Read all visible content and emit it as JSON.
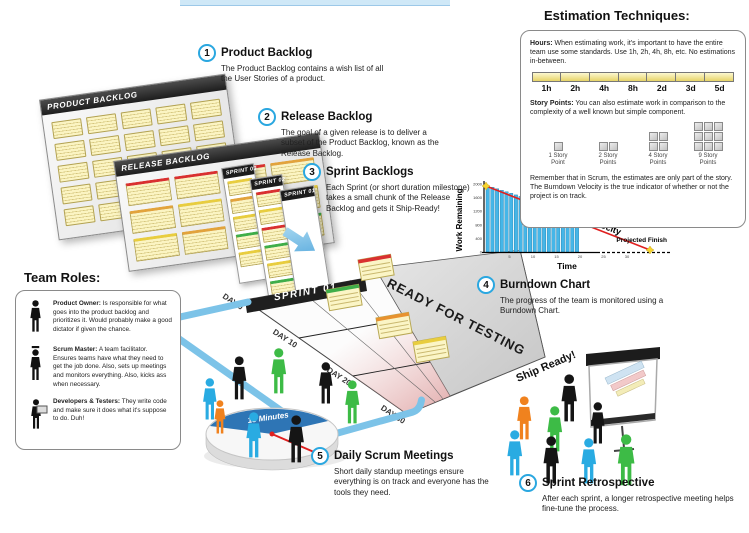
{
  "steps": [
    {
      "num": "1",
      "title": "Product Backlog",
      "body": "The Product Backlog contains a wish list of all the User Stories of a product."
    },
    {
      "num": "2",
      "title": "Release Backlog",
      "body": "The goal of a given release is to deliver a subset of the Product Backlog, known as the Release Backlog."
    },
    {
      "num": "3",
      "title": "Sprint Backlogs",
      "body": "Each Sprint (or short duration milestone) takes a small chunk of the Release Backlog and gets it Ship-Ready!"
    },
    {
      "num": "4",
      "title": "Burndown Chart",
      "body": "The progress of the team is monitored using a Burndown Chart."
    },
    {
      "num": "5",
      "title": "Daily Scrum Meetings",
      "body": "Short daily standup meetings ensure everything is on track and everyone has the tools they need."
    },
    {
      "num": "6",
      "title": "Sprint Retrospective",
      "body": "After each sprint, a longer retrospective meeting helps fine-tune the process."
    }
  ],
  "estimation": {
    "title": "Estimation Techniques:",
    "hours_label": "Hours:",
    "hours_text": "When estimating work, it's important to have the entire team use some standards. Use 1h, 2h, 4h, 8h, etc. No estimations in-between.",
    "ruler_labels": [
      "1h",
      "2h",
      "4h",
      "8h",
      "2d",
      "3d",
      "5d"
    ],
    "story_label": "Story Points:",
    "story_text": "You can also estimate work in comparison to the complexity of a well known but simple component.",
    "story_points": [
      {
        "count": 1,
        "cols": 1,
        "label": "1 Story Point"
      },
      {
        "count": 2,
        "cols": 2,
        "label": "2 Story Points"
      },
      {
        "count": 4,
        "cols": 2,
        "label": "4 Story Points"
      },
      {
        "count": 9,
        "cols": 3,
        "label": "9 Story Points"
      }
    ],
    "footer": "Remember that in Scrum, the estimates are only part of the story. The Burndown Velocity is the true indicator of whether or not the project is on track."
  },
  "team_roles": {
    "title": "Team Roles:",
    "roles": [
      {
        "name": "Product Owner:",
        "icon": "product-owner-icon",
        "text": "Is responsible for what goes into the product backlog and prioritizes it. Would probably make a good dictator if given the chance."
      },
      {
        "name": "Scrum Master:",
        "icon": "scrum-master-icon",
        "text": "A team facilitator. Ensures teams have what they need to get the job done. Also, sets up meetings and monitors everything. Also, kicks ass when necessary."
      },
      {
        "name": "Developers & Testers:",
        "icon": "developer-icon",
        "text": "They write code and make sure it does what it's suppose to do. Duh!"
      }
    ]
  },
  "boards": {
    "product": {
      "label": "PRODUCT BACKLOG",
      "rows": 5,
      "cols": 5
    },
    "release": {
      "label": "RELEASE BACKLOG",
      "stripe_rows": [
        [
          "#d93030",
          "#d93030",
          "#d93030",
          "#e2a33c"
        ],
        [
          "#e2a33c",
          "#e8cd3f",
          "#3fae49",
          "#e8cd3f"
        ],
        [
          "#e8cd3f",
          "#e2a33c",
          "#e8cd3f",
          "#3fae49"
        ]
      ]
    },
    "sprints": [
      {
        "label": "SPRINT 03",
        "stripes": [
          "#e8cd3f",
          "#e2a33c",
          "#e8cd3f",
          "#3fae49",
          "#e8cd3f"
        ]
      },
      {
        "label": "SPRINT 02",
        "stripes": [
          "#d93030",
          "#e8cd3f",
          "#d93030",
          "#3fae49",
          "#e8cd3f",
          "#3fae49"
        ]
      },
      {
        "label": "SPRINT 01",
        "stripes": []
      }
    ],
    "sprint_board_label": "SPRINT 01",
    "ready_label": "READY FOR TESTING",
    "ship_label": "Ship Ready!",
    "day_labels": [
      "DAY 0",
      "DAY 10",
      "DAY 20",
      "DAY 30"
    ],
    "board_notes": [
      {
        "x": 228,
        "y": 10,
        "color": "#d93030"
      },
      {
        "x": 196,
        "y": 40,
        "color": "#3fae49"
      },
      {
        "x": 246,
        "y": 68,
        "color": "#e8922f"
      },
      {
        "x": 283,
        "y": 92,
        "color": "#e8cd3f"
      }
    ]
  },
  "scrum_meeting": {
    "pie_label": "15 Minutes",
    "people": [
      {
        "x": 70,
        "y": 128,
        "h": 42,
        "color": "#29abe2"
      },
      {
        "x": 99,
        "y": 106,
        "h": 44,
        "color": "#151515"
      },
      {
        "x": 138,
        "y": 98,
        "h": 46,
        "color": "#3dbb46"
      },
      {
        "x": 186,
        "y": 112,
        "h": 42,
        "color": "#151515"
      },
      {
        "x": 212,
        "y": 130,
        "h": 44,
        "color": "#3dbb46"
      },
      {
        "x": 82,
        "y": 150,
        "h": 34,
        "color": "#f0821e"
      },
      {
        "x": 113,
        "y": 162,
        "h": 46,
        "color": "#29abe2"
      },
      {
        "x": 155,
        "y": 165,
        "h": 48,
        "color": "#151515"
      }
    ]
  },
  "retrospective": {
    "people": [
      {
        "x": 428,
        "y": 124,
        "h": 48,
        "color": "#151515"
      },
      {
        "x": 384,
        "y": 146,
        "h": 44,
        "color": "#f0821e"
      },
      {
        "x": 414,
        "y": 156,
        "h": 46,
        "color": "#3dbb46"
      },
      {
        "x": 458,
        "y": 152,
        "h": 42,
        "color": "#151515"
      },
      {
        "x": 374,
        "y": 180,
        "h": 46,
        "color": "#29abe2"
      },
      {
        "x": 410,
        "y": 186,
        "h": 48,
        "color": "#151515"
      },
      {
        "x": 448,
        "y": 188,
        "h": 46,
        "color": "#29abe2"
      },
      {
        "x": 484,
        "y": 184,
        "h": 52,
        "color": "#3dbb46"
      }
    ]
  },
  "chart_data": {
    "type": "bar",
    "title": "Burndown Chart",
    "xlabel": "Time",
    "ylabel": "Work Remaining",
    "ylim": [
      0,
      2000
    ],
    "yticks": [
      2000,
      1600,
      1200,
      800,
      400,
      0
    ],
    "xticks": [
      5,
      10,
      15,
      20,
      25,
      30
    ],
    "series": [
      {
        "name": "Work Remaining",
        "values": [
          1950,
          1905,
          1860,
          1815,
          1770,
          1725,
          1680,
          1635,
          1590,
          1545,
          1500,
          1455,
          1410,
          1365,
          1320,
          1275,
          1230,
          1185,
          1140,
          1095
        ]
      }
    ],
    "trend_line": {
      "name": "Burndown Velocity",
      "start": [
        0,
        2000
      ],
      "end": [
        35,
        0
      ],
      "annotation": "Projected Finish"
    },
    "bar_color": "#45b6e8",
    "line_color": "#e02020",
    "legend": false
  }
}
